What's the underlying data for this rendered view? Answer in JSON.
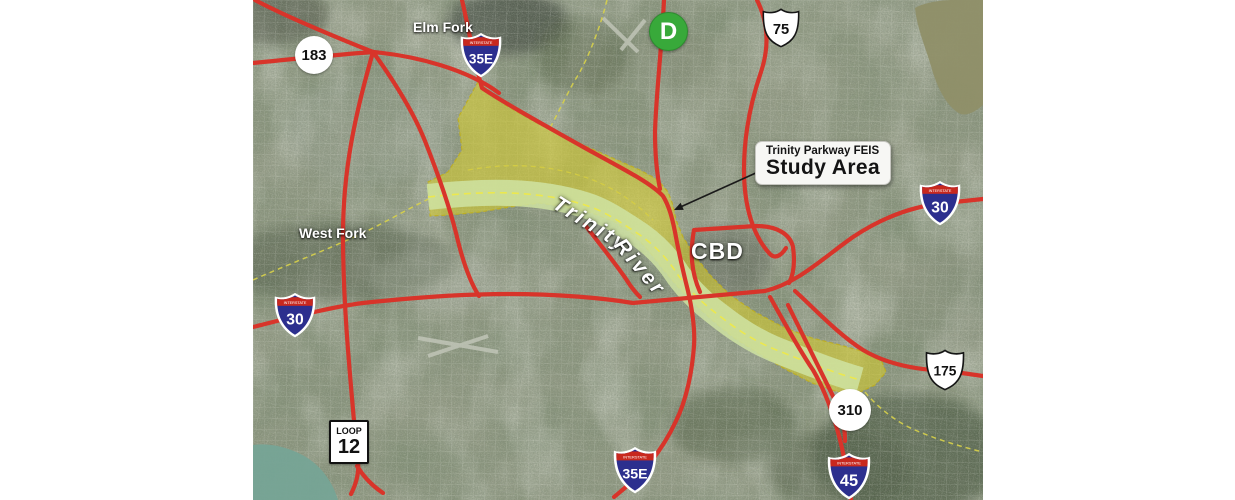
{
  "map": {
    "region_labels": {
      "elm_fork": "Elm Fork",
      "west_fork": "West Fork",
      "cbd": "CBD",
      "trinity": "Trinity",
      "river": "River"
    },
    "callout": {
      "line1": "Trinity Parkway FEIS",
      "line2": "Study Area"
    },
    "shields": {
      "us183": {
        "number": "183"
      },
      "i35e_north": {
        "banner": "INTERSTATE",
        "number": "35E"
      },
      "dnt": {
        "letter": "D"
      },
      "us75": {
        "number": "75"
      },
      "i30_east": {
        "banner": "INTERSTATE",
        "number": "30"
      },
      "i30_west": {
        "banner": "INTERSTATE",
        "number": "30"
      },
      "loop12": {
        "banner": "LOOP",
        "number": "12"
      },
      "sh310": {
        "number": "310"
      },
      "us175": {
        "number": "175"
      },
      "i45": {
        "banner": "INTERSTATE",
        "number": "45"
      },
      "i35e_south": {
        "banner": "INTERSTATE",
        "number": "35E"
      }
    },
    "colors": {
      "road_red": "#d8342a",
      "study_area_yellow": "#d6cd2f",
      "floodway_green": "#cfe3a2",
      "interstate_blue": "#2c2f8e",
      "interstate_red": "#c8281e",
      "dnt_green": "#38a93a",
      "lake_teal": "#76a496",
      "lake_olive": "#8f8f68"
    }
  }
}
